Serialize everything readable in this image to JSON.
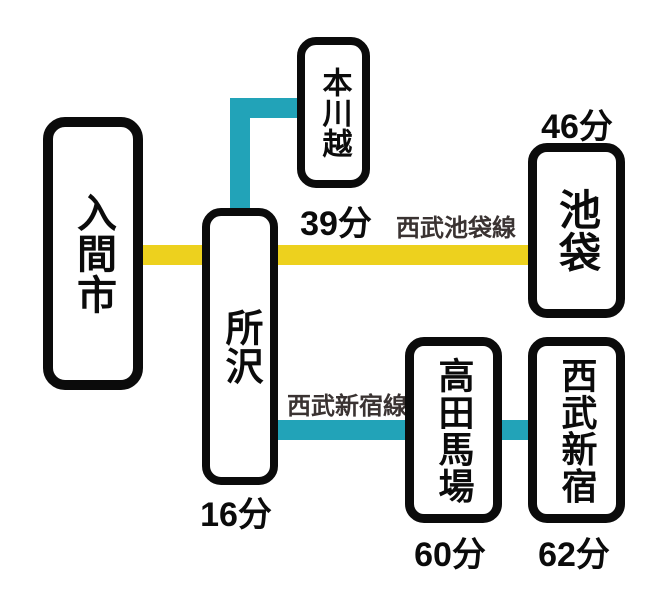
{
  "colors": {
    "background": "#FFFFFF",
    "ink": "#0B0B0B",
    "line_label": "#3A3332",
    "yellow_line": "#EDD11E",
    "teal_line": "#22A3B8"
  },
  "stations": {
    "iruma_shi": {
      "name": "入間市"
    },
    "tokorozawa": {
      "name": "所沢",
      "time": "16分"
    },
    "hon_kawagoe": {
      "name": "本川越",
      "time": "39分"
    },
    "ikebukuro": {
      "name": "池袋",
      "time": "46分"
    },
    "takadanobaba": {
      "name": "高田馬場",
      "time": "60分"
    },
    "seibu_shinjuku": {
      "name": "西武新宿",
      "time": "62分"
    }
  },
  "lines": {
    "seibu_ikebukuro": {
      "label": "西武池袋線",
      "color": "#EDD11E"
    },
    "seibu_shinjuku": {
      "label": "西武新宿線",
      "color": "#22A3B8"
    }
  }
}
